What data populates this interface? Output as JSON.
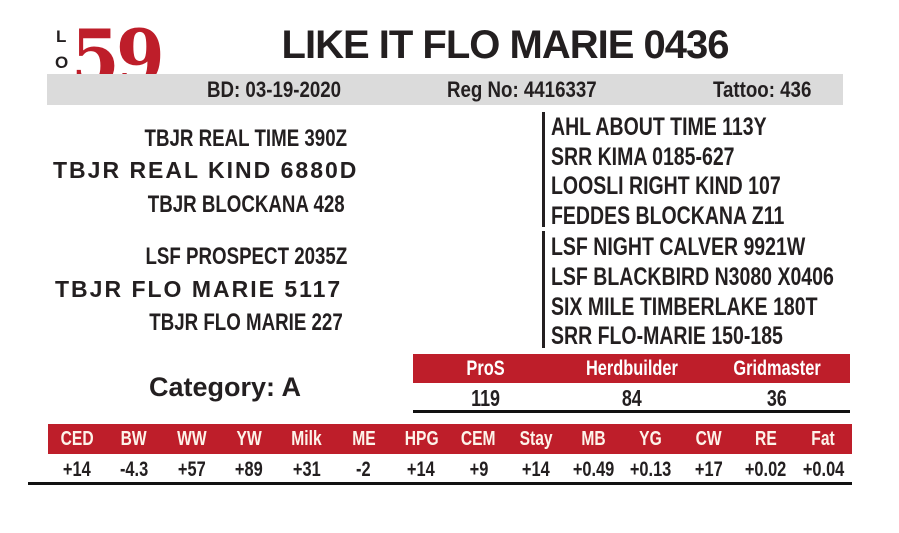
{
  "lot": {
    "letters": [
      "L",
      "O",
      "T"
    ],
    "number": "59"
  },
  "header": {
    "title": "LIKE IT FLO MARIE 0436",
    "birth_date": "BD: 03-19-2020",
    "reg_no": "Reg No: 4416337",
    "tattoo": "Tattoo: 436"
  },
  "pedigree": {
    "sire_line": {
      "grandsire": "TBJR REAL TIME 390Z",
      "sire": "TBJR REAL KIND 6880D",
      "granddam": "TBJR BLOCKANA 428"
    },
    "dam_line": {
      "grandsire": "LSF PROSPECT 2035Z",
      "dam": "TBJR FLO MARIE 5117",
      "granddam": "TBJR FLO MARIE 227"
    },
    "great_grandparents": [
      "AHL ABOUT TIME 113Y",
      "SRR KIMA 0185-627",
      "LOOSLI RIGHT KIND 107",
      "FEDDES BLOCKANA Z11",
      "LSF NIGHT CALVER 9921W",
      "LSF BLACKBIRD N3080 X0406",
      "SIX MILE TIMBERLAKE 180T",
      "SRR FLO-MARIE 150-185"
    ]
  },
  "category": {
    "label": "Category: A"
  },
  "indexes": {
    "headers": [
      "ProS",
      "Herdbuilder",
      "Gridmaster"
    ],
    "values": [
      "119",
      "84",
      "36"
    ]
  },
  "epd": {
    "headers": [
      "CED",
      "BW",
      "WW",
      "YW",
      "Milk",
      "ME",
      "HPG",
      "CEM",
      "Stay",
      "MB",
      "YG",
      "CW",
      "RE",
      "Fat"
    ],
    "values": [
      "+14",
      "-4.3",
      "+57",
      "+89",
      "+31",
      "-2",
      "+14",
      "+9",
      "+14",
      "+0.49",
      "+0.13",
      "+17",
      "+0.02",
      "+0.04"
    ]
  },
  "colors": {
    "accent_red": "#be1e2a",
    "bar_gray": "#dbdbdb",
    "text_black": "#231f20"
  }
}
